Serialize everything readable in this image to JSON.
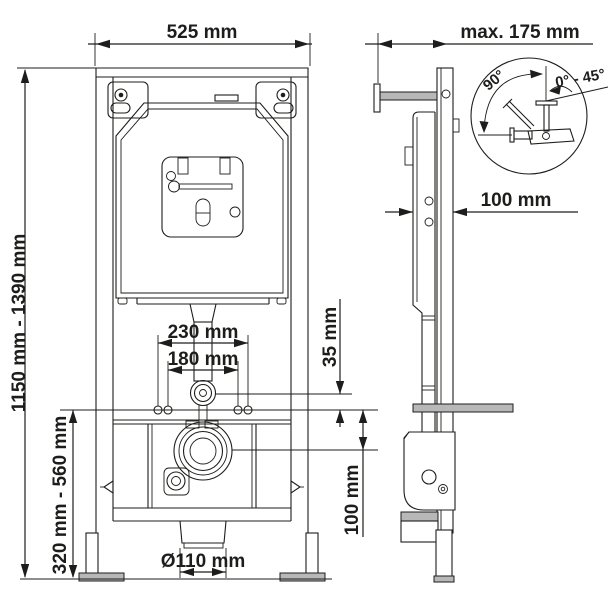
{
  "drawing": {
    "subject": "WC concealed cistern installation frame - dimensional drawing, front and side views",
    "background": "#ffffff",
    "line_color": "#1d1d1b",
    "views": {
      "front": {
        "dimensions": {
          "width": "525 mm",
          "height_range": "1150 mm - 1390 mm",
          "fixing_spacing_outer": "230 mm",
          "fixing_spacing_inner": "180 mm",
          "flush_to_fixings": "35 mm",
          "fixings_to_drain": "100 mm",
          "support_range": "320 mm - 560 mm",
          "outlet_diameter": "Ø110 mm"
        }
      },
      "side": {
        "dimensions": {
          "depth_max": "max. 175 mm",
          "frame_depth": "100 mm"
        },
        "detail": {
          "angle_sweep": "90°",
          "angle_range": "0° - 45°"
        }
      }
    }
  }
}
